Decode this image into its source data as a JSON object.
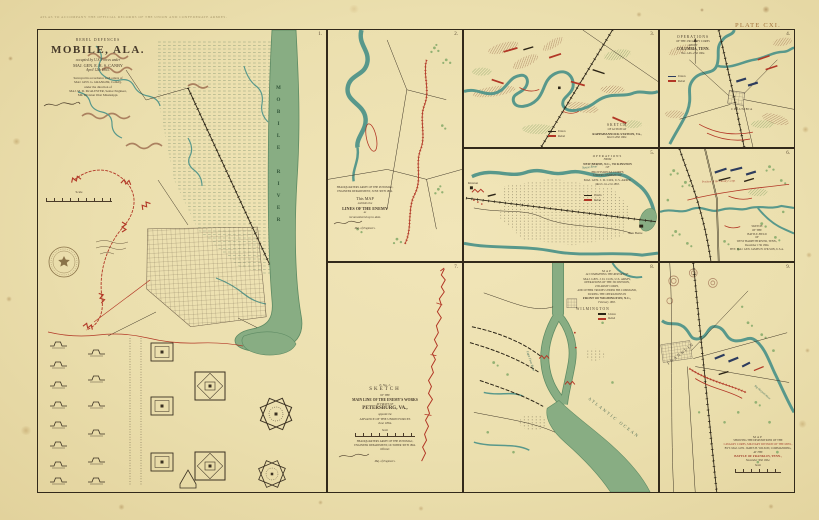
{
  "sheet": {
    "header": "ATLAS TO ACCOMPANY THE OFFICIAL RECORDS OF THE UNION AND CONFEDERATE ARMIES.",
    "plate": "PLATE CXI."
  },
  "palette": {
    "paper": "#ebdfae",
    "frame": "#32291a",
    "river_teal": "#58988b",
    "water_band": "#88ad83",
    "rebel_red": "#b23726",
    "union_dark": "#2b2416",
    "union_blue": "#2d3c5e",
    "ink": "#46392a",
    "hill_brown": "#a07152",
    "vegetation": "#93b173"
  },
  "panel1": {
    "number": "1.",
    "kicker": "REBEL DEFENCES",
    "title": "MOBILE, ALA.",
    "sub1": "occupied by U.S. Forces under",
    "sub2": "MAJ. GEN. E. R. S. CANBY",
    "sub3": "April 12th 1865.",
    "credits": [
      "Surveyed in accordance with orders of",
      "MAJ. GEN. G. GRANGER, Comd'g.",
      "under the direction of",
      "MAJ. M. D. McALESTER, Senior Engineer,",
      "Mil. Division West Mississippi."
    ],
    "scale_label": "Scale",
    "river_label": "MOBILE RIVER"
  },
  "panel2": {
    "number": "2.",
    "hq1": "HEADQUARTERS ARMY OF THE POTOMAC,",
    "hq2": "ENGINEER DEPARTMENT, JUNE 30TH 1864.",
    "line1": "This MAP",
    "line2": "exhibits the",
    "line3": "LINES OF THE ENEMY",
    "line4": "as",
    "line5": "reconnoitered up to date.",
    "official": "Maj. of Engineers."
  },
  "panel3": {
    "number": "3.",
    "c1": "SKETCH",
    "c2": "OF ACTION AT",
    "c3": "RAPPAHANNOCK STATION, VA.,",
    "c4": "March 28th 1862.",
    "legend": [
      "Union",
      "Rebel"
    ]
  },
  "panel4": {
    "number": "4.",
    "t1": "OPERATIONS",
    "t2": "OF THE 23D ARMY CORPS",
    "t3": "ABOUT",
    "t4": "COLUMBIA, TENN.",
    "t5": "Nov. 24th–27th 1864.",
    "legend": [
      "Union",
      "Rebel"
    ],
    "town": "COLUMBIA"
  },
  "panel5": {
    "number": "5.",
    "t1": "OPERATIONS",
    "t2": "FROM",
    "t3": "NEW BERNE, N.C., TO KINSTON",
    "t4": "OF",
    "t5": "PROVISIONAL CORPS",
    "t6": "UNDER COMMAND OF",
    "t7": "MAJ. GEN. J. D. COX, U.S. ARMY,",
    "t8": "March 1st–21st 1865.",
    "legend": [
      "Union",
      "Rebel"
    ],
    "labels": {
      "kinston": "Kinston",
      "newberne": "New Berne",
      "river": "Neuse River"
    }
  },
  "panel6": {
    "number": "6.",
    "red_note": "Position of the Cavalry Corps",
    "c": [
      "SKETCH",
      "OF THE",
      "BATTLE-FIELD",
      "OF",
      "WEST HARPETH RIVER, TENN.,",
      "December 17th 1864.",
      "BVT. MAJ. GEN. JAMES H. WILSON, U.S.A."
    ]
  },
  "panel7": {
    "number": "7.",
    "c1": "E. No. 1.",
    "c2": "SKETCH",
    "c3": "OF THE",
    "c4": "MAIN LINE OF THE ENEMY'S WORKS",
    "c5": "IN FRONT OF",
    "c6": "PETERSBURG, VA.,",
    "c7": "opposite the",
    "c8": "ADVANCE OF THE UNION FORCES",
    "c9": "June 1864.",
    "scale_label": "Scale",
    "f": [
      "HEADQUARTERS ARMY OF THE POTOMAC,",
      "ENGINEER DEPARTMENT, OCTOBER 30TH 1864.",
      "Official:"
    ],
    "official": "Maj. of Engineers."
  },
  "panel8": {
    "number": "8.",
    "t1": "MAP",
    "t2": "ACCOMPANYING THE REPORT OF",
    "t3": "MAJ. GEN. J. D. COX, U.S. ARMY,",
    "mid": [
      "OPERATIONS OF THE 3D DIVISION,",
      "23D ARMY CORPS,",
      "AND OTHER TROOPS UNDER HIS COMMAND,",
      "DURING THE OPERATIONS IN"
    ],
    "t4": "FRONT OF WILMINGTON, N.C.,",
    "t5": "February 1865.",
    "legend": [
      "Union",
      "Rebel"
    ],
    "labels": {
      "town": "WILMINGTON",
      "river": "Cape Fear River",
      "ocean": "ATLANTIC OCEAN"
    }
  },
  "panel9": {
    "number": "9.",
    "c1": "MAP",
    "c2": "SHOWING THE DISPOSITIONS OF THE",
    "c3": "CAVALRY CORPS, MILITARY DIVISION OF THE MISS.,",
    "c4": "BVT. MAJ. GEN. JAMES H. WILSON, COMMANDING,",
    "c5": "AT THE",
    "c6": "BATTLE OF FRANKLIN, TENN.,",
    "c7": "November 30th 1864.",
    "scale_label": "Scale",
    "labels": {
      "town": "FRANKLIN",
      "river": "Big Harpeth River"
    }
  }
}
